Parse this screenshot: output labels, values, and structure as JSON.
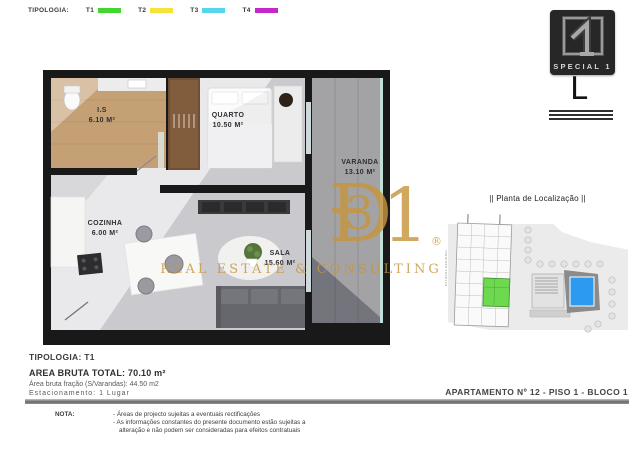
{
  "legend": {
    "label": "TIPOLOGIA:",
    "items": [
      {
        "code": "T1",
        "color": "#42d62e"
      },
      {
        "code": "T2",
        "color": "#f5e33b"
      },
      {
        "code": "T3",
        "color": "#55d6ec"
      },
      {
        "code": "T4",
        "color": "#c427cb"
      }
    ]
  },
  "brand": {
    "caption": "SPECIAL 1",
    "mark": "L"
  },
  "floorplan": {
    "rooms": [
      {
        "name": "I.S",
        "area": "6.10 M²"
      },
      {
        "name": "QUARTO",
        "area": "10.50 M²"
      },
      {
        "name": "VARANDA",
        "area": "13.10 M²"
      },
      {
        "name": "COZINHA",
        "area": "6.00 M²"
      },
      {
        "name": "SALA",
        "area": "15.60 M²"
      }
    ]
  },
  "watermark": {
    "char_d": "Ð",
    "char_3": "3",
    "char_1": "1",
    "registered": "®",
    "caption": "REAL ESTATE & CONSULTING",
    "color": "#c6953e"
  },
  "location": {
    "title": "|| Planta de Localização ||",
    "street_label": "ESTRADA REGIONAL",
    "unit_color": "#6cd94e",
    "pool_color": "#2b9af0"
  },
  "summary": {
    "tipologia": "TIPOLOGIA: T1",
    "area_total": "AREA BRUTA TOTAL: 70.10 m²",
    "area_fracao": "Área bruta fração (S/Varandas): 44.50 m2",
    "estacionamento": "Estacionamento: 1 Lugar"
  },
  "apartment_ref": "APARTAMENTO Nº  12 - PISO 1 - BLOCO 1",
  "nota": {
    "label": "NOTA:",
    "line1": "- Áreas de projecto sujeitas a eventuais rectificações",
    "line2": "- As informações constantes do presente documento estão sujeitas a",
    "line3": "alteração e não podem ser consideradas para efeitos contratuais"
  }
}
